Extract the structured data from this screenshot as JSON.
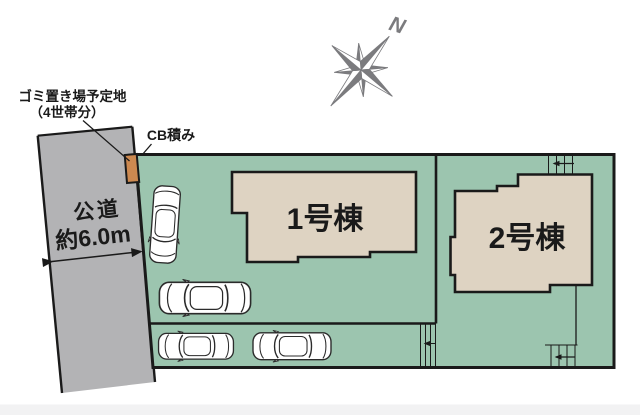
{
  "annotations": {
    "garbage": {
      "line1": "ゴミ置き場予定地",
      "line2": "（4世帯分）"
    },
    "cb_wall_label": "CB積み"
  },
  "road": {
    "name": "公道",
    "width_label": "約6.0m"
  },
  "buildings": {
    "b1": {
      "label": "1号棟"
    },
    "b2": {
      "label": "2号棟"
    }
  },
  "compass": {
    "north_label": "N"
  },
  "colors": {
    "plot_green": "#9cc5af",
    "building_beige": "#ded3c2",
    "road_gray": "#b3b3b5",
    "cb_orange": "#cd8950",
    "outline": "#1a1a1a",
    "compass_gray": "#7b7b7e"
  }
}
